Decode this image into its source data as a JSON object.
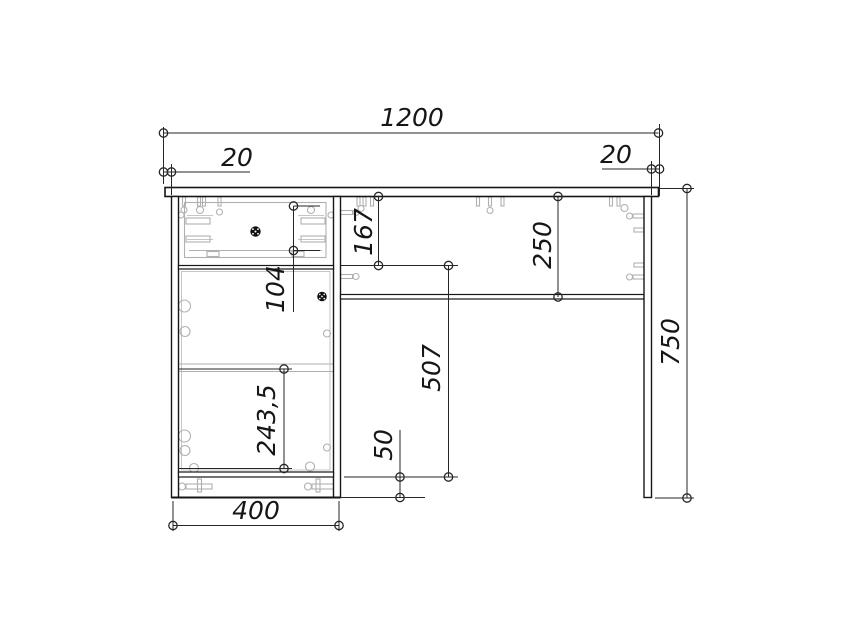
{
  "drawing_meta": {
    "kind": "furniture-technical-drawing",
    "view": "desk front elevation with dimensions",
    "units": "mm",
    "line_color": "#161616",
    "hidden_line_color": "#b0b0b0"
  },
  "dims": {
    "total_width": "1200",
    "overhang_left": "20",
    "overhang_right": "20",
    "drawer_section_height": "167",
    "apron_height": "250",
    "drawer_inner_height": "104",
    "knee_clearance_height": "507",
    "door_panel_height": "243,5",
    "plinth_height": "50",
    "pedestal_width": "400",
    "total_height": "750"
  }
}
